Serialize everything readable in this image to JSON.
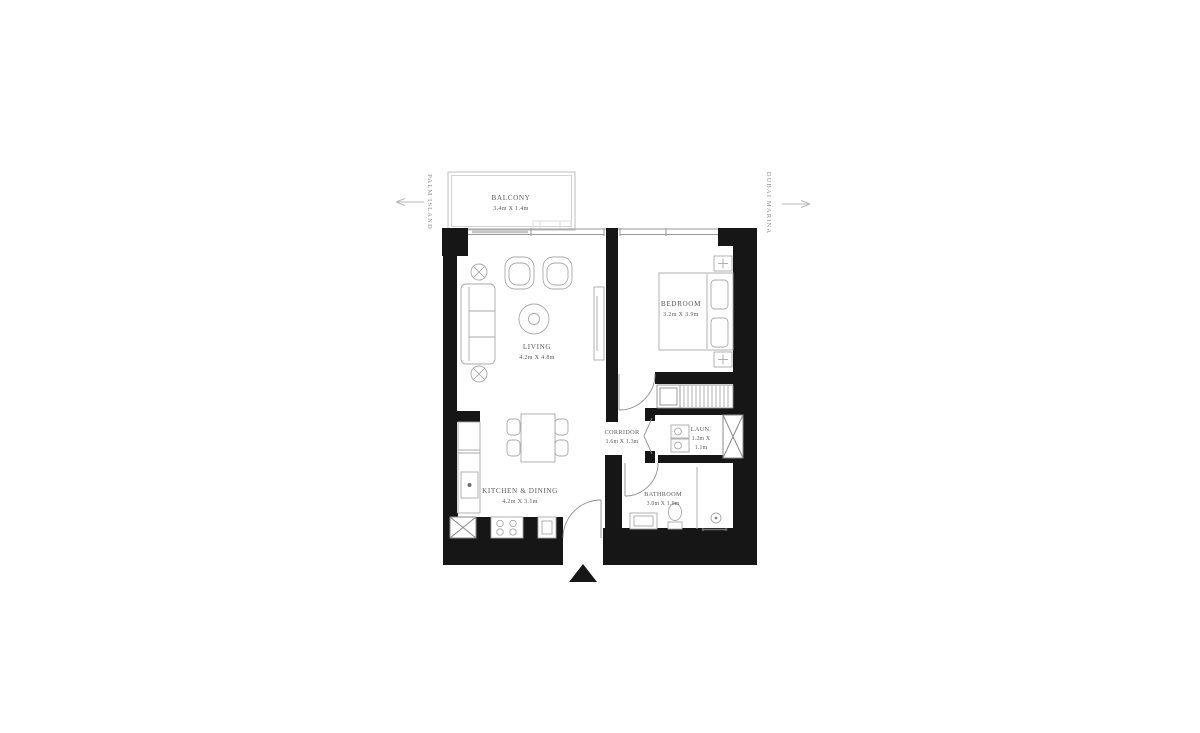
{
  "plan_title": "one-bedroom-apartment-floor-plan",
  "compass": {
    "left_label": "PALM ISLAND",
    "right_label": "DUBAI MARINA"
  },
  "rooms": {
    "balcony": {
      "name": "BALCONY",
      "dims": "3.4m X 1.4m"
    },
    "living": {
      "name": "LIVING",
      "dims": "4.2m X 4.8m"
    },
    "bedroom": {
      "name": "BEDROOM",
      "dims": "3.2m X 3.9m"
    },
    "corridor": {
      "name": "CORRIDOR",
      "dims": "1.6m X 1.3m"
    },
    "laundry": {
      "name": "LAUN.",
      "dims_line1": "1.2m X",
      "dims_line2": "1.1m"
    },
    "kitchen": {
      "name": "KITCHEN & DINING",
      "dims": "4.2m X 3.1m"
    },
    "bathroom": {
      "name": "BATHROOM",
      "dims": "3.0m X 1.9m"
    }
  },
  "colors": {
    "wall": "#161616",
    "furniture_line": "#a8a8a8",
    "window_line": "#9a9a9a",
    "label_text": "#5a5a5a",
    "compass_text": "#8c8c8c"
  }
}
